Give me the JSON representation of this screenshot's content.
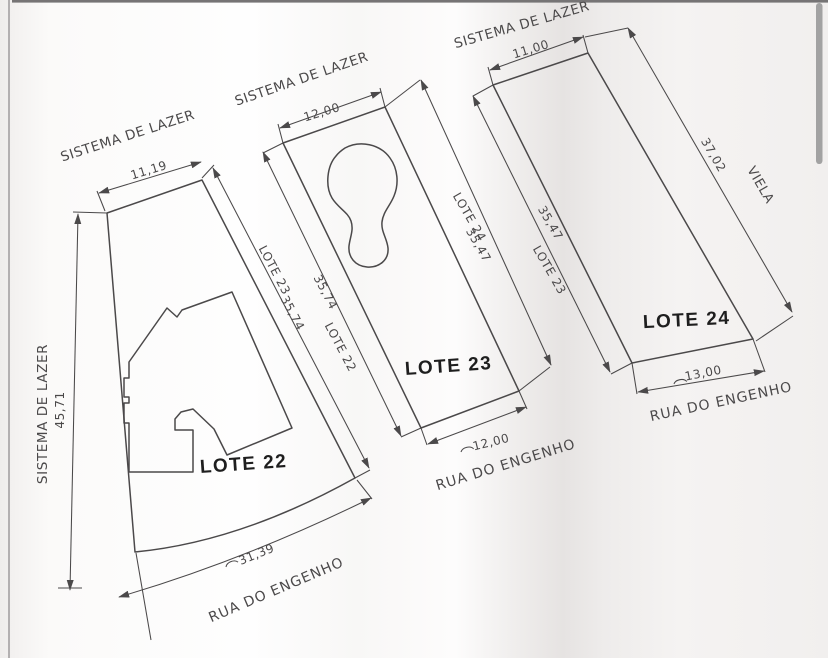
{
  "lots": [
    {
      "name": "LOTE 22",
      "top_area_label": "SISTEMA DE LAZER",
      "top_dim": "11,19",
      "left_area_label": "SISTEMA DE LAZER",
      "left_dim": "45,71",
      "right_neighbor": "LOTE 23",
      "right_dim": "35,74",
      "bottom_dim": "31,39",
      "bottom_street": "RUA DO ENGENHO"
    },
    {
      "name": "LOTE 23",
      "top_area_label": "SISTEMA DE LAZER",
      "top_dim": "12,00",
      "left_neighbor": "LOTE 22",
      "left_dim": "35,74",
      "right_neighbor": "LOTE 24",
      "right_dim": "35,47",
      "bottom_dim": "12,00",
      "bottom_street": "RUA DO ENGENHO"
    },
    {
      "name": "LOTE 24",
      "top_area_label": "SISTEMA DE LAZER",
      "top_dim": "11,00",
      "left_neighbor": "LOTE 23",
      "left_dim": "35,47",
      "right_dim": "37,02",
      "right_street": "VIELA",
      "bottom_dim": "13,00",
      "bottom_street": "RUA DO ENGENHO"
    }
  ],
  "colors": {
    "ink": "#4b494a",
    "bold_ink": "#1e1e1e",
    "paper": "#ffffff",
    "fold_shadow": "#e7e4e3",
    "scrollbar": "#a2a2a2"
  }
}
